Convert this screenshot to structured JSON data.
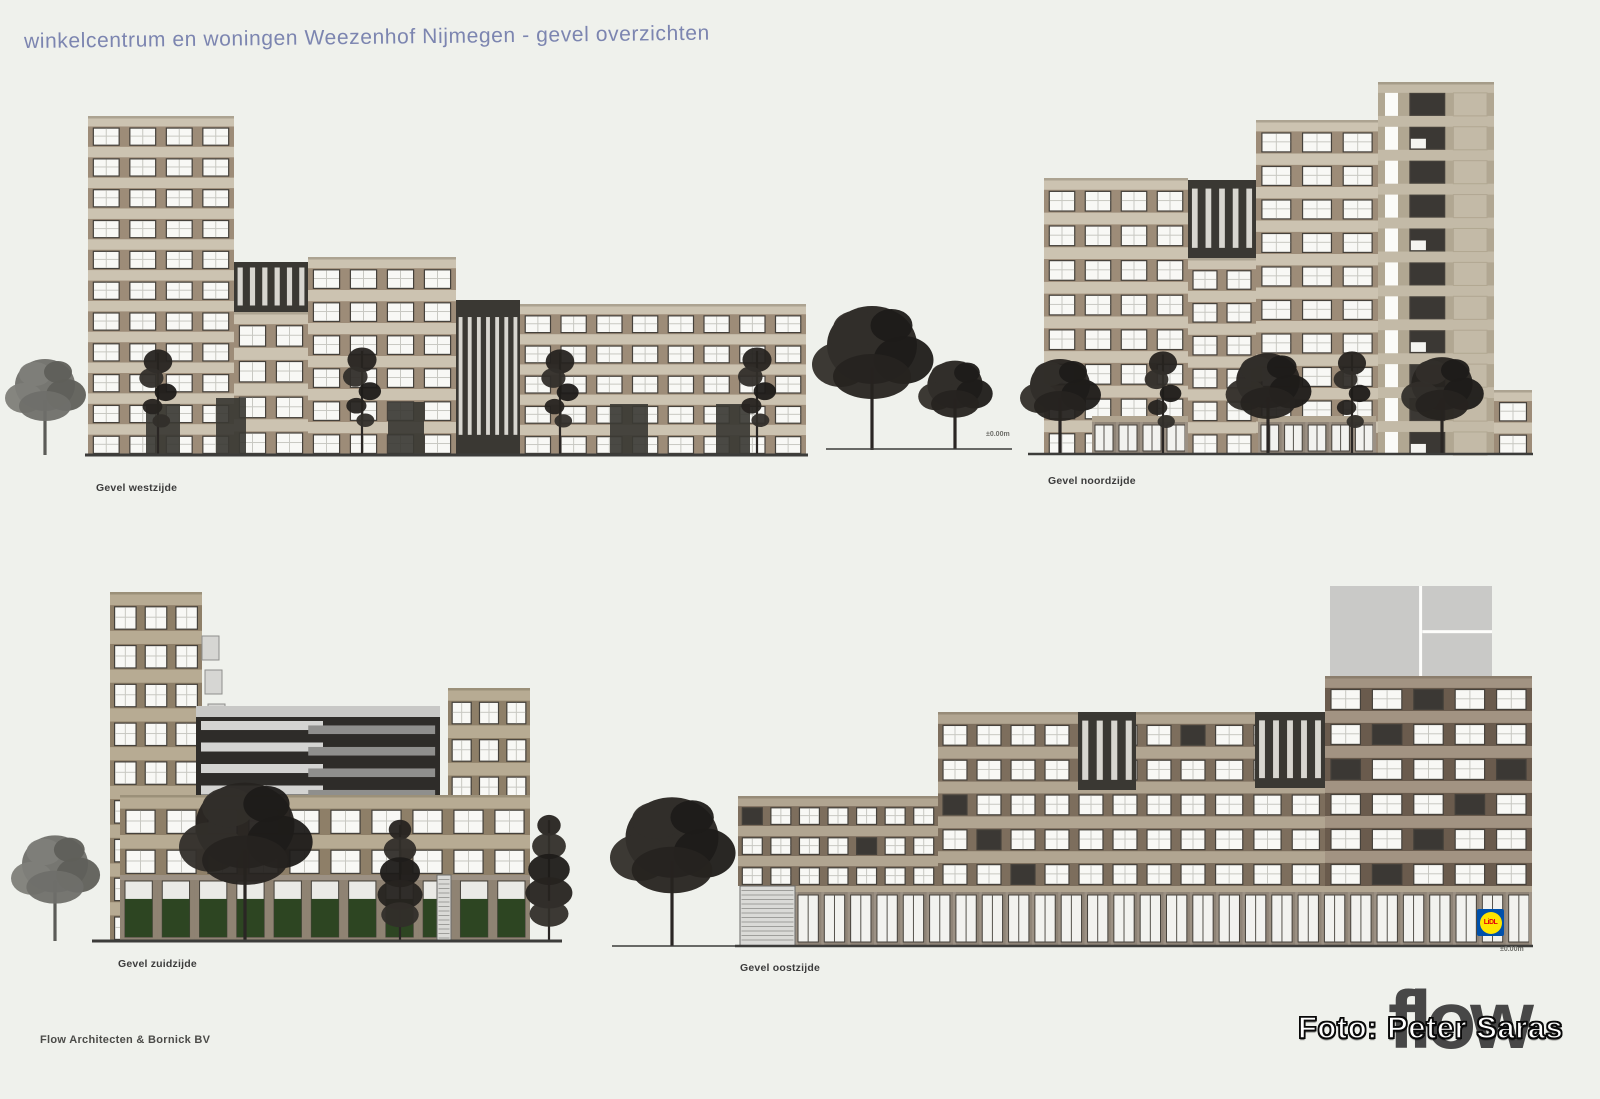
{
  "sheet": {
    "title": "winkelcentrum en woningen Weezenhof Nijmegen - gevel overzichten",
    "credit": "Flow Architecten & Bornick BV",
    "photo_credit": "Foto: Peter Saras",
    "logo_text": "flow",
    "colors": {
      "background": "#eff1ec",
      "title_blue": "#7c85b0",
      "facade_beige": "#ccc3b1",
      "facade_taupe": "#b7ab93",
      "facade_brick": "#b1a591",
      "dark_block": "#3a3833",
      "lidl_blue": "#0050aa",
      "lidl_yellow": "#ffe500",
      "lidl_red": "#e3000b"
    }
  },
  "labels": {
    "west": {
      "text": "Gevel westzijde"
    },
    "noord": {
      "text": "Gevel noordzijde"
    },
    "zuid": {
      "text": "Gevel zuidzijde"
    },
    "oost": {
      "text": "Gevel oostzijde"
    }
  },
  "annotations": {
    "mid_level": {
      "text": "±0.00m"
    },
    "east_level": {
      "text": "±0.00m"
    }
  },
  "lidl": {
    "text": "LiDL"
  },
  "drawing": {
    "grounds": [
      {
        "x1": 85,
        "x2": 808,
        "y": 455,
        "w": 3
      },
      {
        "x1": 826,
        "x2": 1012,
        "y": 449,
        "w": 1.5
      },
      {
        "x1": 1028,
        "x2": 1533,
        "y": 454,
        "w": 2.5
      },
      {
        "x1": 92,
        "x2": 562,
        "y": 941,
        "w": 3
      },
      {
        "x1": 612,
        "x2": 735,
        "y": 946,
        "w": 1.5
      },
      {
        "x1": 735,
        "x2": 1533,
        "y": 946,
        "w": 2.5
      }
    ],
    "masses": [
      {
        "t": "grid",
        "x": 88,
        "y": 116,
        "w": 146,
        "h": 339,
        "f": 11,
        "b": 4
      },
      {
        "t": "dark",
        "x": 234,
        "y": 262,
        "w": 74,
        "h": 50,
        "s": 6
      },
      {
        "t": "grid",
        "x": 234,
        "y": 312,
        "w": 74,
        "h": 143,
        "f": 4,
        "b": 2
      },
      {
        "t": "grid",
        "x": 308,
        "y": 257,
        "w": 148,
        "h": 198,
        "f": 6,
        "b": 4
      },
      {
        "t": "dark",
        "x": 456,
        "y": 300,
        "w": 64,
        "h": 155,
        "s": 7
      },
      {
        "t": "grid",
        "x": 520,
        "y": 304,
        "w": 286,
        "h": 151,
        "f": 5,
        "b": 8
      },
      {
        "t": "darkpatch",
        "x": 146,
        "y": 404,
        "w": 34,
        "h": 51
      },
      {
        "t": "darkpatch",
        "x": 216,
        "y": 398,
        "w": 30,
        "h": 57
      },
      {
        "t": "darkpatch",
        "x": 388,
        "y": 402,
        "w": 36,
        "h": 53
      },
      {
        "t": "darkpatch",
        "x": 610,
        "y": 404,
        "w": 38,
        "h": 51
      },
      {
        "t": "darkpatch",
        "x": 716,
        "y": 404,
        "w": 34,
        "h": 51
      },
      {
        "t": "grid",
        "x": 1044,
        "y": 178,
        "w": 144,
        "h": 277,
        "f": 8,
        "b": 4
      },
      {
        "t": "dark",
        "x": 1188,
        "y": 180,
        "w": 68,
        "h": 78,
        "s": 5
      },
      {
        "t": "grid",
        "x": 1188,
        "y": 258,
        "w": 68,
        "h": 197,
        "f": 6,
        "b": 2
      },
      {
        "t": "grid",
        "x": 1256,
        "y": 120,
        "w": 122,
        "h": 335,
        "f": 10,
        "b": 3
      },
      {
        "t": "towerdark",
        "x": 1378,
        "y": 82,
        "w": 116,
        "h": 373,
        "f": 11
      },
      {
        "t": "grid",
        "x": 1494,
        "y": 390,
        "w": 38,
        "h": 65,
        "f": 2,
        "b": 1
      },
      {
        "t": "storefront",
        "x": 1092,
        "y": 416,
        "w": 96,
        "h": 39
      },
      {
        "t": "storefront",
        "x": 1258,
        "y": 416,
        "w": 118,
        "h": 39
      },
      {
        "t": "grid",
        "x": 110,
        "y": 592,
        "w": 92,
        "h": 349,
        "f": 9,
        "b": 3,
        "c": "taupe"
      },
      {
        "t": "balc",
        "x": 202,
        "y": 636,
        "w": 17,
        "n": 3
      },
      {
        "t": "parking",
        "x": 196,
        "y": 706,
        "w": 244,
        "h": 100
      },
      {
        "t": "grid",
        "x": 448,
        "y": 688,
        "w": 82,
        "h": 187,
        "f": 5,
        "b": 3,
        "c": "taupe"
      },
      {
        "t": "grid",
        "x": 120,
        "y": 795,
        "w": 410,
        "h": 80,
        "f": 2,
        "b": 10,
        "c": "taupe"
      },
      {
        "t": "plants",
        "x": 120,
        "y": 875,
        "w": 410,
        "h": 66
      },
      {
        "t": "roller",
        "x": 437,
        "y": 875,
        "w": 14,
        "h": 66
      },
      {
        "t": "shaft",
        "x": 1330,
        "y": 586,
        "w": 162,
        "h": 92
      },
      {
        "t": "grid",
        "x": 938,
        "y": 712,
        "w": 272,
        "h": 174,
        "f": 5,
        "b": 8,
        "c": "brick",
        "dk": 9
      },
      {
        "t": "grid",
        "x": 1210,
        "y": 712,
        "w": 115,
        "h": 174,
        "f": 5,
        "b": 3,
        "c": "brick"
      },
      {
        "t": "dark",
        "x": 1078,
        "y": 712,
        "w": 58,
        "h": 78,
        "s": 4
      },
      {
        "t": "dark",
        "x": 1255,
        "y": 712,
        "w": 70,
        "h": 76,
        "s": 5
      },
      {
        "t": "grid",
        "x": 738,
        "y": 796,
        "w": 200,
        "h": 90,
        "f": 3,
        "b": 7,
        "c": "brick",
        "dk": 11
      },
      {
        "t": "grid",
        "x": 1325,
        "y": 676,
        "w": 207,
        "h": 210,
        "f": 6,
        "b": 5,
        "c": "brickdark",
        "dk": 4
      },
      {
        "t": "storefront",
        "x": 795,
        "y": 886,
        "w": 737,
        "h": 60
      },
      {
        "t": "roller",
        "x": 740,
        "y": 886,
        "w": 55,
        "h": 60
      }
    ],
    "trees": [
      {
        "x": 45,
        "g": 455,
        "h": 100,
        "t": "round",
        "tone": "light"
      },
      {
        "x": 158,
        "g": 455,
        "h": 110,
        "t": "slim"
      },
      {
        "x": 362,
        "g": 455,
        "h": 112,
        "t": "slim"
      },
      {
        "x": 560,
        "g": 455,
        "h": 110,
        "t": "slim"
      },
      {
        "x": 757,
        "g": 455,
        "h": 112,
        "t": "slim"
      },
      {
        "x": 872,
        "g": 450,
        "h": 150,
        "t": "round"
      },
      {
        "x": 955,
        "g": 449,
        "h": 92,
        "t": "round"
      },
      {
        "x": 1060,
        "g": 455,
        "h": 100,
        "t": "round"
      },
      {
        "x": 1163,
        "g": 455,
        "h": 108,
        "t": "slim"
      },
      {
        "x": 1268,
        "g": 455,
        "h": 106,
        "t": "round"
      },
      {
        "x": 1352,
        "g": 455,
        "h": 108,
        "t": "slim"
      },
      {
        "x": 1442,
        "g": 455,
        "h": 102,
        "t": "round"
      },
      {
        "x": 55,
        "g": 941,
        "h": 110,
        "t": "round",
        "tone": "light"
      },
      {
        "x": 245,
        "g": 941,
        "h": 165,
        "t": "round"
      },
      {
        "x": 400,
        "g": 941,
        "h": 125,
        "t": "conifer"
      },
      {
        "x": 549,
        "g": 941,
        "h": 130,
        "t": "conifer"
      },
      {
        "x": 672,
        "g": 946,
        "h": 155,
        "t": "round"
      }
    ]
  }
}
